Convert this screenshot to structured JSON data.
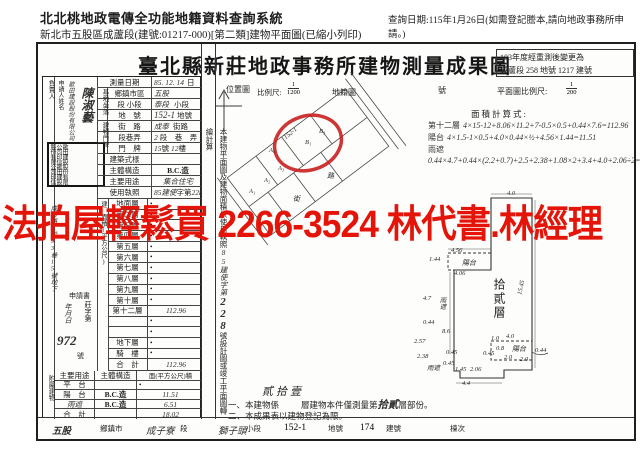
{
  "header": {
    "system_title": "北北桃地政電傳全功能地籍資料查詢系統",
    "subtitle": "新北市五股區成蘆段(建號:01217-000)[第二類]建物平面圖(已縮小列印)",
    "query_date": "查詢日期:115年1月26日(如需登記謄本,請向地政事務所申請。)"
  },
  "doc": {
    "title": "臺北縣新莊地政事務所建物測量成果圖",
    "remark_line1": "103年度經重測後變更為",
    "remark_line2": "成蘆段 258 地號 1217 建號"
  },
  "watermark": "法拍屋輕鬆買 2266-3524 林代書.林經理",
  "applicant": {
    "side": "負責人",
    "label": "申請人姓名",
    "company": "歌田建設股份有限公司",
    "name": "陳淑藝",
    "stamp": "歌田建設股份有限公司印信歌田建設股份有限公司印信",
    "address": "成泰路2段93巷15號地下",
    "receipt_doc": "申請書",
    "receipt_prefix": "莊字第",
    "receipt_no": "972",
    "receipt_suffix": "號",
    "receipt_date": "年月日"
  },
  "survey": {
    "date_label": "測量日期",
    "date": "85. 12. 14",
    "date_suffix": "日"
  },
  "site": {
    "group": "基地坐落",
    "r1_label": "鄉鎮市區",
    "r1_hw": "五股",
    "r2_label": "段 小段",
    "r2_hw": "泰段",
    "r2_printed": "小段",
    "r3_label": "地　號",
    "r3_hw": "152-1",
    "r3_printed": "地號"
  },
  "door": {
    "group": "建物門牌",
    "r1_label": "街　路",
    "r1_hw": "成泰",
    "r1_printed": "街路",
    "r2_label": "段巷弄",
    "r2_hw": "2",
    "r2_printed": "段　巷　弄",
    "r3_label": "門　牌",
    "r3_hw": "15",
    "r3_printed": "號",
    "r3_hw2": "12",
    "r3_printed2": "樓"
  },
  "building": {
    "style_label": "建築式樣",
    "style": "",
    "struct_label": "主體構造",
    "struct": "B.C.造",
    "use_label": "主要用途",
    "use": "集合住宅",
    "license_label": "使用執照",
    "lic1": "85建使",
    "lic2": "字第",
    "lic3": "228",
    "lic4": "號"
  },
  "area": {
    "side": "建　面積(平方公尺)",
    "floors": [
      {
        "label": "地面層",
        "value": "•"
      },
      {
        "label": "第二層",
        "value": "•"
      },
      {
        "label": "第三層",
        "value": "•"
      },
      {
        "label": "第四層",
        "value": "•"
      },
      {
        "label": "第五層",
        "value": "•"
      },
      {
        "label": "第六層",
        "value": "•"
      },
      {
        "label": "第七層",
        "value": "•"
      },
      {
        "label": "第八層",
        "value": "•"
      },
      {
        "label": "第九層",
        "value": "•"
      },
      {
        "label": "第十層",
        "value": "•"
      },
      {
        "label": "第十二層",
        "value": "112.96"
      },
      {
        "label": "",
        "value": "•"
      },
      {
        "label": "",
        "value": "•"
      },
      {
        "label": "地下層",
        "value": "•"
      },
      {
        "label": "騎　樓",
        "value": "•"
      }
    ],
    "total_label": "合　計",
    "total": "112.96"
  },
  "annex": {
    "side": "附屬建物",
    "h_use": "主要用途",
    "h_struct": "主體構造",
    "h_area": "面(平方公尺)積",
    "rows": [
      {
        "use": "平　台",
        "struct": "",
        "area": "•"
      },
      {
        "use": "陽　台",
        "struct": "B.C.造",
        "area": "11.51"
      },
      {
        "use": "雨遮",
        "struct": "B.C.造",
        "area": "6.51"
      },
      {
        "use": "合　計",
        "struct": "",
        "area": "18.02"
      }
    ]
  },
  "strip": {
    "p1": "本建物平面圖及建物面積依使用執照",
    "hw": "85建使字第",
    "no": "228",
    "p2": "號設計圖或竣工平面圖轉繪計算"
  },
  "maps": {
    "loc_label": "位置圖",
    "scale_label": "比例尺:",
    "scale_num": "1",
    "scale_den": "1200",
    "cad_label": "地籍圖",
    "cad_suffix": "號",
    "plan_scale_label": "平面圖比例尺:",
    "plan_num": "1",
    "plan_den": "200",
    "calc_label": "面積計算式:",
    "f1_name": "第十二層",
    "f1_expr": "4×15-12+8.06×11.2+7-0.5×0.5+0.44×7.6=112.96",
    "f2_name": "陽台",
    "f2_expr": "4×1.5-1×0.5+4.0×0.44×½+4.56×1.44=11.51",
    "f3_name": "雨遮",
    "f3_expr": "0.44×4.7+0.44×(2.2+0.7)+2.5+2.38+1.08×2+3.4+4.0+2.06÷2=6.53",
    "blocks": [
      "A₁",
      "A₂",
      "A₃",
      "A₄",
      "B₁",
      "B₃"
    ],
    "parcel": "152-1",
    "road": "路",
    "street": "街"
  },
  "plan": {
    "floor_label": "拾貳層",
    "balcony": "陽台",
    "canopy": "雨遮",
    "dims": {
      "d1": "4.0",
      "d2": "4.56",
      "d3": "1.44",
      "d4": "4.06",
      "d5": "15.45",
      "d6": "4.7",
      "d7": "0.44",
      "d8": "2.57",
      "d9": "8.6",
      "d10": "2.38",
      "d11": "0.45",
      "d12": "0.45",
      "d13": "1.45",
      "d14": "2.06",
      "d15": "0.45",
      "d16": "4.4",
      "d17": "1.0",
      "d18": "4.0",
      "d19": "0.8",
      "d20": "2.0",
      "d21": "2.0",
      "d22": "0.44"
    }
  },
  "notes": {
    "hw_total": "貳拾壹",
    "n1a": "一、本建物係",
    "n1b": "層建物本件僅測量第",
    "n1hw": "拾貳",
    "n1c": "層部份。",
    "n2": "二、本成果表以建物登記為限。"
  },
  "footer": {
    "v1": "五股",
    "l1": "鄉鎮市",
    "v2": "成子寮",
    "l2": "段",
    "v3": "獅子頭",
    "l3": "小段",
    "v4": "152-1",
    "l4": "地號",
    "v5": "174",
    "l5": "建號",
    "l6": "棟次"
  }
}
